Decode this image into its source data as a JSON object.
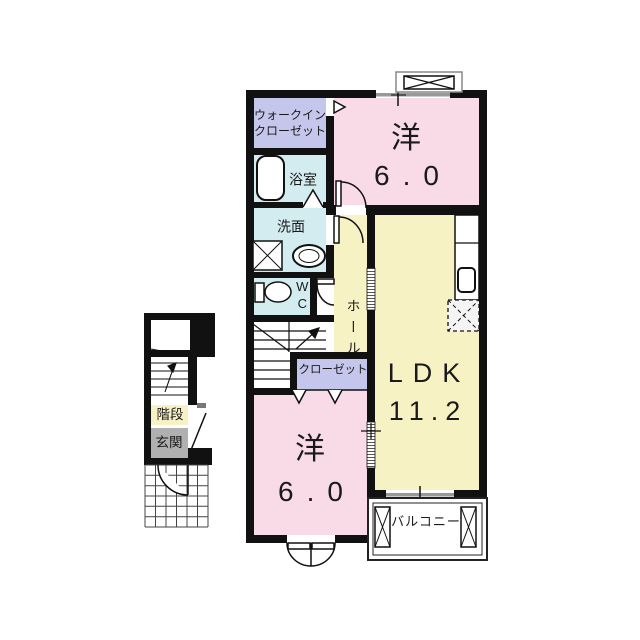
{
  "rooms": {
    "walkin_closet": {
      "line1": "ウォークイン",
      "line2": "クローゼット"
    },
    "bath": {
      "label": "浴室"
    },
    "washroom": {
      "label": "洗面"
    },
    "toilet": {
      "label": "WC"
    },
    "hall": {
      "label": "ホール"
    },
    "closet": {
      "label": "クローゼット"
    },
    "bedroom_top": {
      "name": "洋",
      "size": "6.0"
    },
    "bedroom_bottom": {
      "name": "洋",
      "size": "6.0"
    },
    "ldk": {
      "name": "LDK",
      "size": "11.2"
    },
    "balcony": {
      "label": "バルコニー"
    },
    "stairs": {
      "label": "階段"
    },
    "entrance": {
      "label": "玄関"
    }
  },
  "colors": {
    "wall": "#111111",
    "room_pink": "#f9dbe8",
    "room_yellow": "#f7f2c4",
    "closet_purple": "#c5c6ec",
    "wet_area_cyan": "#d3ecf0",
    "entrance_gray": "#b0b0b0",
    "window_gray": "#999999"
  }
}
